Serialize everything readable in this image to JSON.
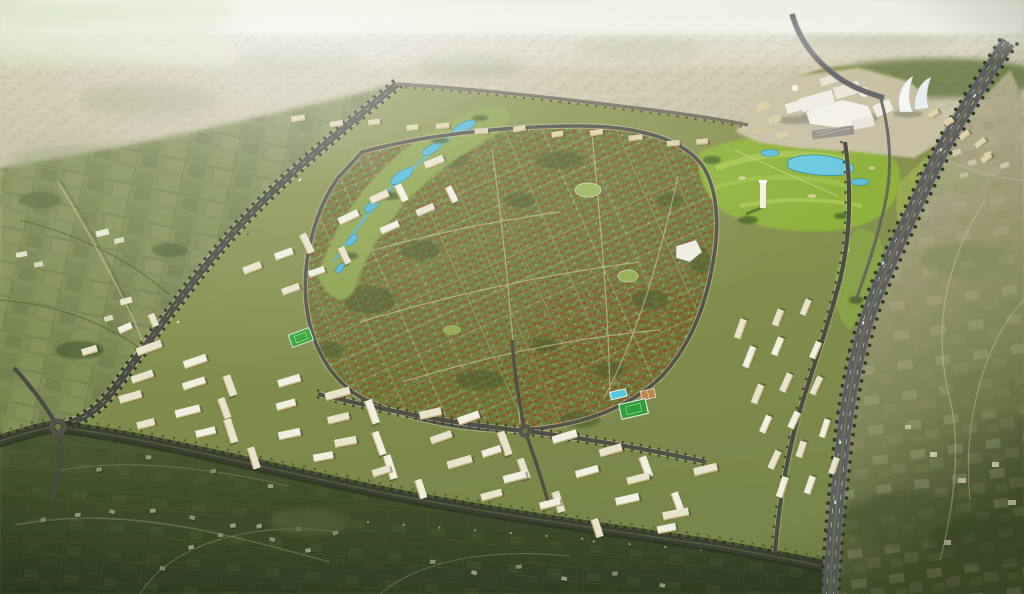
{
  "meta": {
    "title": "Aerial render of a master-planned community",
    "description": "Bird's-eye architectural rendering of a large new-town development: a diamond-shaped district of green villa neighborhoods around a central park with blue lakes, a golf course and white commercial hub with sail-shaped towers at the north-east, dense white apartment slab districts along the west and south edges, a tree-lined perimeter highway curving down the east side, hazy existing city on the horizon and dark green countryside in the foreground.",
    "image_type": "architectural aerial rendering",
    "dimensions": "1024x594"
  },
  "palette": {
    "sky": "#eef0e0",
    "haze_top": "#e7ead6",
    "haze_city": "#c7c1a6",
    "haze_speck": "#aaa489",
    "farmland": "#7d8a55",
    "farmland_dark": "#4c5a34",
    "suburb": "#46522e",
    "suburb_dark": "#323e24",
    "lane": "#8a9168",
    "desert": "#b3ab8c",
    "desert_dark": "#8f8a6d",
    "desert_green": "#6f7c4b",
    "dev_base": "#84904e",
    "villa_green": "#6e7e3f",
    "villa_tree": "#42562b",
    "park_green": "#8da24e",
    "golf_green": "#8fb23e",
    "golf_light": "#b7d45e",
    "lake_blue": "#55b8d6",
    "lake_deep": "#2e89a8",
    "road_dark": "#45453d",
    "road_edge": "#d6d2b0",
    "highway_asphalt": "#5e5e60",
    "highway_shoulder": "#8b8b80",
    "median_green": "#6d7550",
    "tree_dark": "#2e3d22",
    "block_roof": "#f1efe2",
    "block_roof_alt": "#e8e3cd",
    "block_wall": "#c8b37e",
    "block_shadow": "#2f3a20",
    "commercial_white": "#efede1",
    "plaza_tan": "#c9c0a4",
    "beige_block": "#ddd2ac",
    "house_roof": "#959a82",
    "house_roof_alt": "#868b71",
    "pitch_green": "#35a438",
    "pool_cyan": "#54c8dc",
    "court_tan": "#c08448",
    "car_light": "#f4f4f0",
    "car_dark": "#3c3c40",
    "car_red": "#8a3a30",
    "glow": "#ffffff",
    "vignette": "#1c2410"
  },
  "scene": {
    "regions": [
      {
        "name": "horizon-sky",
        "label": "Pale hazy sky band at the horizon"
      },
      {
        "name": "distant-city-haze",
        "label": "Hazy beige existing city sprawl across the top"
      },
      {
        "name": "west-farmland",
        "label": "Green farmland with hedgerows west of the development"
      },
      {
        "name": "southwest-suburb",
        "label": "Dark green existing suburb with scattered houses in the foreground"
      },
      {
        "name": "east-countryside",
        "label": "Olive-tan countryside east of the highway"
      },
      {
        "name": "masterplan-development",
        "label": "Diamond-shaped new town development plate"
      },
      {
        "name": "villa-neighborhoods",
        "label": "Central villa blocks with red-brown roofs in green fabric"
      },
      {
        "name": "central-park-stream",
        "label": "Park ribbon with winding blue lakes and stream"
      },
      {
        "name": "golf-course",
        "label": "Bright green golf course with ponds"
      },
      {
        "name": "commercial-hub",
        "label": "White commercial and retail hub at the north-east"
      },
      {
        "name": "sail-towers",
        "label": "Two curved sail-shaped white towers"
      },
      {
        "name": "landmark-tower",
        "label": "Slender white high-rise landmark near the golf course"
      },
      {
        "name": "apartment-districts",
        "label": "Grids of white apartment slab blocks along west and south edges"
      },
      {
        "name": "north-edge-blocks",
        "label": "Row of mid-rise blocks along the northern edge"
      },
      {
        "name": "east-apartment-district",
        "label": "Columns of apartment slabs near the highway"
      },
      {
        "name": "northwest-boulevard",
        "label": "Tree-lined boulevard on the north-west boundary"
      },
      {
        "name": "south-perimeter-avenue",
        "label": "Tree-lined avenue on the southern boundary"
      },
      {
        "name": "inner-ring-road",
        "label": "Loop road around the villa core"
      },
      {
        "name": "ring-highway",
        "label": "Divided highway curving along the eastern edge"
      },
      {
        "name": "roundabout-west",
        "label": "Roundabout at the south-west corner"
      },
      {
        "name": "roundabout-central",
        "label": "Roundabout on the internal avenue"
      },
      {
        "name": "sports-club",
        "label": "Sports club with pool, courts and pitch"
      },
      {
        "name": "neighborhood-pitch",
        "label": "Small green football pitch in the west district"
      },
      {
        "name": "village-cluster",
        "label": "Small white village buildings in the farmland"
      },
      {
        "name": "vehicles",
        "label": "Tiny cars on the highway and boulevard"
      },
      {
        "name": "sun-haze",
        "label": "Bright atmospheric glow over the upper left"
      }
    ],
    "lighting": "Soft daylight with strong pale haze toward the horizon, darker saturated greens in the foreground"
  }
}
